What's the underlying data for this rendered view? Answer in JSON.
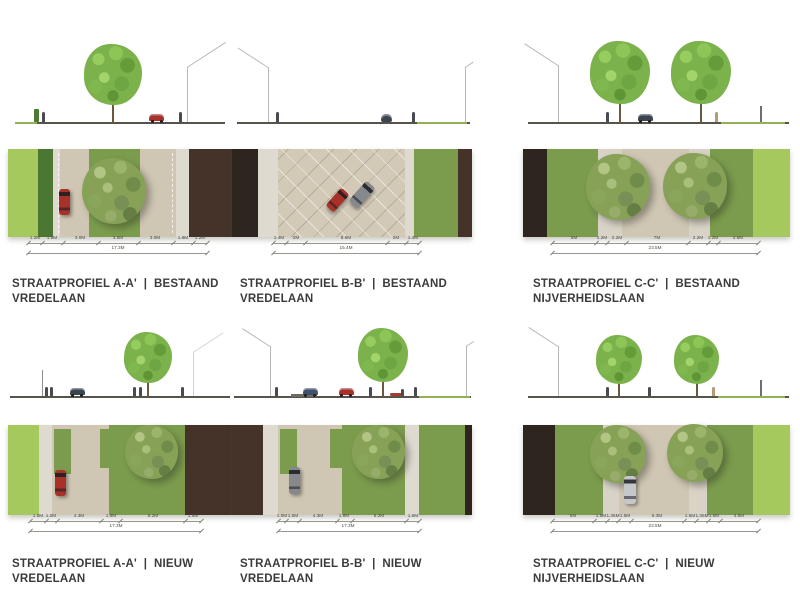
{
  "document": {
    "background": "#ffffff",
    "type": "street-profile-sheet"
  },
  "palette": {
    "grassLight": "#a6c95e",
    "grassMed": "#7b9c4d",
    "hedge": "#4b7733",
    "sidewalk": "#dedad0",
    "path": "#d8d3c6",
    "road": "#cfc6b3",
    "roadPaved": "#d2c9b7",
    "building": "#453329",
    "buildingDark": "#2f251f",
    "carRed": "#a8322a",
    "carGray": "#85898e",
    "carDark": "#3c4450",
    "carBlue": "#41506b",
    "carSilver": "#c6c7c9",
    "dimLine": "#97978f",
    "dimText": "#4a4a46",
    "titleText": "#3b3b3b",
    "groundLine": "#56534b"
  },
  "panels": [
    {
      "name": "a-a-bestaand",
      "title": "STRAATPROFIEL A-A'  |  BESTAAND",
      "subtitle": "VREDELAAN",
      "dimensions": {
        "segments": [
          "1.2M",
          "1.8M",
          "3.0M",
          "3.5M",
          "3.0M",
          "1.8M",
          "1.2M"
        ],
        "total": "17.3M",
        "inset": [
          9,
          11
        ]
      },
      "plan": {
        "strips": [
          [
            "grassLight",
            13.5
          ],
          [
            "hedge",
            6.5
          ],
          [
            "sidewalk",
            3
          ],
          [
            "road",
            13
          ],
          [
            "grassMed",
            23
          ],
          [
            "road",
            16
          ],
          [
            "sidewalk",
            6
          ],
          [
            "building",
            19
          ]
        ],
        "trees": [
          {
            "x": 47.5,
            "y": 48,
            "d": 64
          }
        ],
        "cars": [
          {
            "x": 25,
            "y": 60,
            "w": 11,
            "h": 26,
            "color": "carRed",
            "angle": 0
          }
        ],
        "bays": [],
        "dashes": [
          22.5,
          73
        ],
        "paving": null
      },
      "elevation": {
        "ground": [
          3,
          97
        ],
        "items": [
          {
            "t": "grassline",
            "x": 3,
            "w": 10
          },
          {
            "t": "hedge",
            "x": 12.5
          },
          {
            "t": "person",
            "x": 15.8
          },
          {
            "t": "tree",
            "x": 47,
            "s": 1.02
          },
          {
            "t": "car",
            "x": 66.5,
            "color": "carRed"
          },
          {
            "t": "person",
            "x": 77
          },
          {
            "t": "gable",
            "x": 80,
            "dir": "r",
            "h": 55,
            "len": 46
          }
        ]
      }
    },
    {
      "name": "b-b-bestaand",
      "title": "STRAATPROFIEL B-B'  |  BESTAAND",
      "subtitle": "VREDELAAN",
      "dimensions": {
        "segments": [
          "1.4M",
          "2M",
          "8.6M",
          "2M",
          "1.4M"
        ],
        "total": "15.4M",
        "inset": [
          17,
          22
        ]
      },
      "plan": {
        "strips": [
          [
            "buildingDark",
            11
          ],
          [
            "sidewalk",
            8
          ],
          [
            "roadPaved",
            53
          ],
          [
            "sidewalk",
            4
          ],
          [
            "grassMed",
            18
          ],
          [
            "building",
            6
          ]
        ],
        "trees": [],
        "cars": [
          {
            "x": 44,
            "y": 58,
            "w": 11,
            "h": 24,
            "color": "carRed",
            "angle": 42
          },
          {
            "x": 54,
            "y": 52,
            "w": 12,
            "h": 27,
            "color": "carGray",
            "angle": 42
          }
        ],
        "bays": [],
        "dashes": [],
        "paving": {
          "from": 19,
          "to": 72
        }
      },
      "elevation": {
        "ground": [
          2,
          99
        ],
        "items": [
          {
            "t": "gable",
            "x": 15,
            "dir": "l",
            "h": 55,
            "len": 36
          },
          {
            "t": "person",
            "x": 19
          },
          {
            "t": "carRear",
            "x": 64.5,
            "color": "carDark"
          },
          {
            "t": "person",
            "x": 75.5
          },
          {
            "t": "grassline",
            "x": 77,
            "w": 21
          },
          {
            "t": "gable",
            "x": 97,
            "dir": "r",
            "h": 55,
            "len": 10
          }
        ]
      }
    },
    {
      "name": "c-c-bestaand",
      "title": "STRAATPROFIEL C-C'  |  BESTAAND",
      "subtitle": "NIJVERHEIDSLAAN",
      "dimensions": {
        "segments": [
          "5M",
          "1.2M",
          "2.2M",
          "7M",
          "2.2M",
          "1.2M",
          "4.5M"
        ],
        "total": "23.5M",
        "inset": [
          11,
          12
        ]
      },
      "plan": {
        "strips": [
          [
            "buildingDark",
            9
          ],
          [
            "grassMed",
            19
          ],
          [
            "path",
            9
          ],
          [
            "road",
            25
          ],
          [
            "path",
            8
          ],
          [
            "grassMed",
            16
          ],
          [
            "grassLight",
            14
          ]
        ],
        "trees": [
          {
            "x": 35.5,
            "y": 43,
            "d": 64
          },
          {
            "x": 64.5,
            "y": 42,
            "d": 64
          }
        ],
        "cars": [],
        "bays": [],
        "dashes": [],
        "paving": null
      },
      "elevation": {
        "ground": [
          2,
          99.5
        ],
        "items": [
          {
            "t": "gable",
            "x": 13,
            "dir": "l",
            "h": 57,
            "len": 40
          },
          {
            "t": "person",
            "x": 31.8
          },
          {
            "t": "tree",
            "x": 36.3,
            "s": 1.05
          },
          {
            "t": "car",
            "x": 45.7,
            "color": "carDark"
          },
          {
            "t": "tree",
            "x": 66.7,
            "s": 1.05
          },
          {
            "t": "person",
            "x": 72.3,
            "variant": "tan"
          },
          {
            "t": "grassline",
            "x": 74,
            "w": 24
          },
          {
            "t": "post",
            "x": 88.8
          }
        ]
      }
    },
    {
      "name": "a-a-nieuw",
      "title": "STRAATPROFIEL A-A'  |  NIEUW",
      "subtitle": "VREDELAAN",
      "dimensions": {
        "segments": [
          "1.5M",
          "1.0M",
          "4.3M",
          "1.8M",
          "6.2M",
          "1.5M"
        ],
        "total": "17.3M",
        "inset": [
          10,
          14
        ]
      },
      "plan": {
        "strips": [
          [
            "grassLight",
            14
          ],
          [
            "sidewalk",
            5.5
          ],
          [
            "road",
            25.5
          ],
          [
            "grassMed",
            34
          ],
          [
            "building",
            21
          ]
        ],
        "trees": [
          {
            "x": 64,
            "y": 30,
            "d": 53
          }
        ],
        "cars": [
          {
            "x": 23.5,
            "y": 64,
            "w": 11,
            "h": 26,
            "color": "carRed",
            "angle": 0
          }
        ],
        "bays": [
          {
            "x": 20.5,
            "y": 4,
            "w": 7.5,
            "h": 50
          },
          {
            "x": 41,
            "y": 4,
            "w": 4.5,
            "h": 44
          }
        ],
        "dashes": [],
        "paving": null
      },
      "elevation": {
        "ground": [
          1,
          99
        ],
        "items": [
          {
            "t": "pole",
            "x": 15
          },
          {
            "t": "person",
            "x": 17
          },
          {
            "t": "person",
            "x": 19.5
          },
          {
            "t": "car",
            "x": 31,
            "color": "carDark"
          },
          {
            "t": "person",
            "x": 56.5
          },
          {
            "t": "person",
            "x": 59
          },
          {
            "t": "tree",
            "x": 62.5,
            "s": 1.05
          },
          {
            "t": "person",
            "x": 77.7
          },
          {
            "t": "gable",
            "x": 82.5,
            "dir": "r",
            "h": 44,
            "len": 36,
            "faint": true
          }
        ]
      }
    },
    {
      "name": "b-b-nieuw",
      "title": "STRAATPROFIEL B-B'  |  NIEUW",
      "subtitle": "VREDELAAN",
      "dimensions": {
        "segments": [
          "1.0M",
          "1.5M",
          "4.3M",
          "1.8M",
          "6.2M",
          "1.5M"
        ],
        "total": "17.3M",
        "inset": [
          19,
          22
        ]
      },
      "plan": {
        "strips": [
          [
            "building",
            13
          ],
          [
            "sidewalk",
            6
          ],
          [
            "road",
            27
          ],
          [
            "grassMed",
            26
          ],
          [
            "sidewalk",
            6
          ],
          [
            "grassMed",
            19
          ],
          [
            "buildingDark",
            3
          ]
        ],
        "trees": [
          {
            "x": 61,
            "y": 30,
            "d": 53
          }
        ],
        "cars": [
          {
            "x": 26,
            "y": 62,
            "w": 11,
            "h": 27,
            "color": "carGray",
            "angle": 0
          }
        ],
        "bays": [
          {
            "x": 20,
            "y": 4,
            "w": 7,
            "h": 50
          },
          {
            "x": 41,
            "y": 4,
            "w": 5,
            "h": 44
          }
        ],
        "dashes": [],
        "paving": null
      },
      "elevation": {
        "ground": [
          1,
          99.5
        ],
        "items": [
          {
            "t": "gable",
            "x": 16,
            "dir": "l",
            "h": 50,
            "len": 33
          },
          {
            "t": "person",
            "x": 18.7
          },
          {
            "t": "patch",
            "x": 30
          },
          {
            "t": "car",
            "x": 32.5,
            "color": "carBlue"
          },
          {
            "t": "car",
            "x": 47.5,
            "color": "carRed"
          },
          {
            "t": "person",
            "x": 57.5
          },
          {
            "t": "tree",
            "x": 63,
            "s": 1.1
          },
          {
            "t": "shrub",
            "x": 68.5
          },
          {
            "t": "person",
            "x": 71,
            "small": true
          },
          {
            "t": "person",
            "x": 76.5
          },
          {
            "t": "grassline",
            "x": 78,
            "w": 21
          },
          {
            "t": "gable",
            "x": 97.5,
            "dir": "r",
            "h": 50,
            "len": 9
          }
        ]
      }
    },
    {
      "name": "c-c-nieuw",
      "title": "STRAATPROFIEL C-C'  |  NIEUW",
      "subtitle": "NIJVERHEIDSLAAN",
      "dimensions": {
        "segments": [
          "5M",
          "1.5M",
          "1.35M",
          "1.5M",
          "6.3M",
          "1.5M",
          "1.35M",
          "1.5M",
          "4.5M"
        ],
        "total": "23.5M",
        "inset": [
          11,
          12
        ]
      },
      "plan": {
        "strips": [
          [
            "buildingDark",
            12
          ],
          [
            "grassMed",
            18
          ],
          [
            "path",
            6
          ],
          [
            "road",
            26
          ],
          [
            "path",
            7
          ],
          [
            "grassMed",
            17
          ],
          [
            "grassLight",
            14
          ]
        ],
        "trees": [
          {
            "x": 35.5,
            "y": 32,
            "d": 56
          },
          {
            "x": 64.5,
            "y": 31,
            "d": 56
          }
        ],
        "cars": [
          {
            "x": 40,
            "y": 72,
            "w": 12,
            "h": 28,
            "color": "carSilver",
            "angle": 0
          }
        ],
        "bays": [],
        "dashes": [],
        "paving": null
      },
      "elevation": {
        "ground": [
          2,
          99.5
        ],
        "items": [
          {
            "t": "gable",
            "x": 13,
            "dir": "l",
            "h": 50,
            "len": 35
          },
          {
            "t": "person",
            "x": 31.5
          },
          {
            "t": "tree",
            "x": 36,
            "s": 1
          },
          {
            "t": "person",
            "x": 47.5
          },
          {
            "t": "tree",
            "x": 65,
            "s": 1
          },
          {
            "t": "person",
            "x": 71.5,
            "variant": "tan"
          },
          {
            "t": "grassline",
            "x": 73,
            "w": 25
          },
          {
            "t": "post",
            "x": 88.8
          }
        ]
      }
    }
  ]
}
